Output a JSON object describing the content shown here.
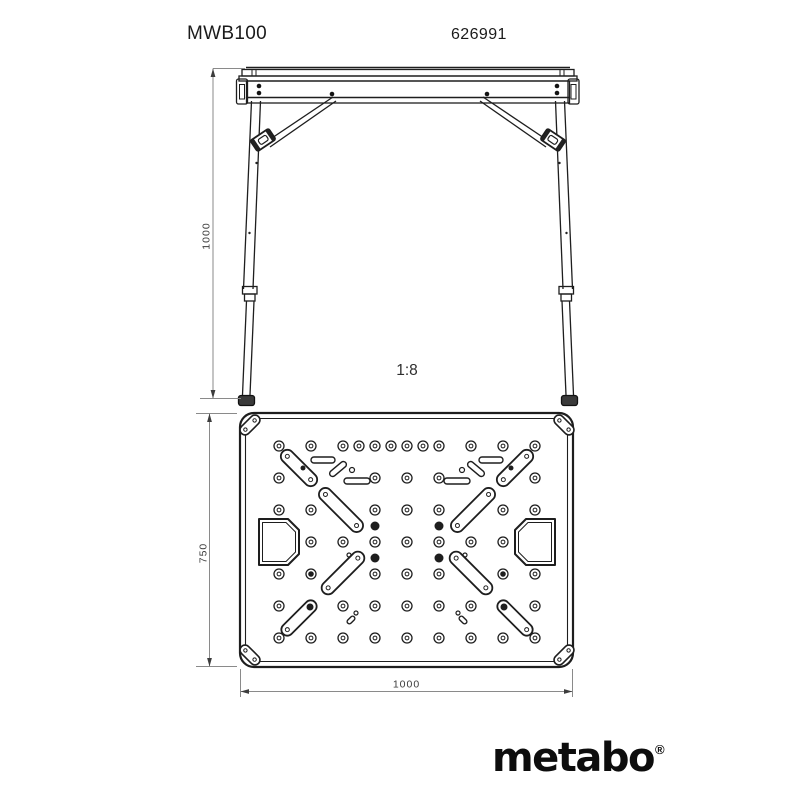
{
  "header": {
    "model": "MWB100",
    "article_number": "626991"
  },
  "scale_label": "1:8",
  "front_view": {
    "height_dim": "1000"
  },
  "top_view": {
    "depth_dim": "750",
    "width_dim": "1000",
    "frame": {
      "x": 240,
      "y": 413,
      "w": 333,
      "h": 254,
      "outer_radius": 14,
      "inner_inset": 5.5,
      "inner_radius": 10
    },
    "mirror_axis_x": 814,
    "mirror_axis_y": 1080,
    "hole_outer_r": 5,
    "hole_inner_r": 1.9,
    "hole_rows": [
      {
        "y": 446,
        "xs": [
          279,
          311,
          343,
          359,
          375,
          391,
          407,
          423,
          439,
          471,
          503,
          535
        ]
      },
      {
        "y": 478,
        "xs": [
          279,
          375,
          407,
          439,
          535
        ]
      },
      {
        "y": 510,
        "xs": [
          279,
          311,
          375,
          407,
          439,
          503,
          535
        ]
      },
      {
        "y": 542,
        "xs": [
          311,
          343,
          375,
          407,
          439,
          471,
          503
        ]
      },
      {
        "y": 574,
        "xs": [
          279,
          375,
          407,
          439,
          535
        ]
      },
      {
        "y": 606,
        "xs": [
          279,
          343,
          375,
          407,
          439,
          471,
          535
        ]
      },
      {
        "y": 638,
        "xs": [
          279,
          311,
          343,
          375,
          407,
          439,
          471,
          503,
          535
        ]
      }
    ],
    "black_dots": [
      {
        "x": 375,
        "y": 526
      },
      {
        "x": 375,
        "y": 558
      }
    ],
    "black_dot_r": 4.5,
    "pivot_holes": [
      {
        "x": 311,
        "y": 574
      }
    ],
    "tiny_circles": [
      {
        "x": 352,
        "y": 470,
        "r": 2.5
      },
      {
        "x": 349,
        "y": 555,
        "r": 2
      },
      {
        "x": 356,
        "y": 613,
        "r": 2
      }
    ],
    "slot_marks": [
      {
        "x": 303,
        "y": 468,
        "r": 2.5
      },
      {
        "x": 310,
        "y": 607,
        "r": 3.5
      }
    ],
    "slots": [
      {
        "cx": 299,
        "cy": 468,
        "len": 46,
        "w": 13,
        "ang": 45,
        "ends": true
      },
      {
        "cx": 323,
        "cy": 460,
        "len": 24,
        "w": 6,
        "ang": 0,
        "ends": false
      },
      {
        "cx": 338,
        "cy": 469,
        "len": 20,
        "w": 6,
        "ang": -40,
        "ends": false
      },
      {
        "cx": 357,
        "cy": 481,
        "len": 26,
        "w": 6,
        "ang": 0,
        "ends": false
      },
      {
        "cx": 341,
        "cy": 510,
        "len": 57,
        "w": 13,
        "ang": 45,
        "ends": true
      },
      {
        "cx": 343,
        "cy": 573,
        "len": 55,
        "w": 13,
        "ang": -45,
        "ends": true
      },
      {
        "cx": 299,
        "cy": 618,
        "len": 45,
        "w": 12,
        "ang": -45,
        "ends": true
      },
      {
        "cx": 351,
        "cy": 620,
        "len": 9,
        "w": 4.5,
        "ang": -45,
        "ends": false
      }
    ],
    "corner_bracket": {
      "cx": 250,
      "cy": 425,
      "len": 24,
      "w": 10,
      "ang": -45,
      "hole_offset": 6.5,
      "hole_r": 1.7
    },
    "cutout": {
      "x": 259,
      "y": 519,
      "w": 40,
      "h": 46,
      "chamfer": 11,
      "inner_inset": 3.5
    }
  },
  "logo": {
    "text": "metabo",
    "registered_mark": "®"
  },
  "colors": {
    "line": "#1e1e1e",
    "dim_line": "#8a8a8a",
    "dim_text": "#3c3c3c",
    "arrow": "#3c3c3c",
    "background": "#ffffff",
    "logo": "#0d0d0d"
  }
}
